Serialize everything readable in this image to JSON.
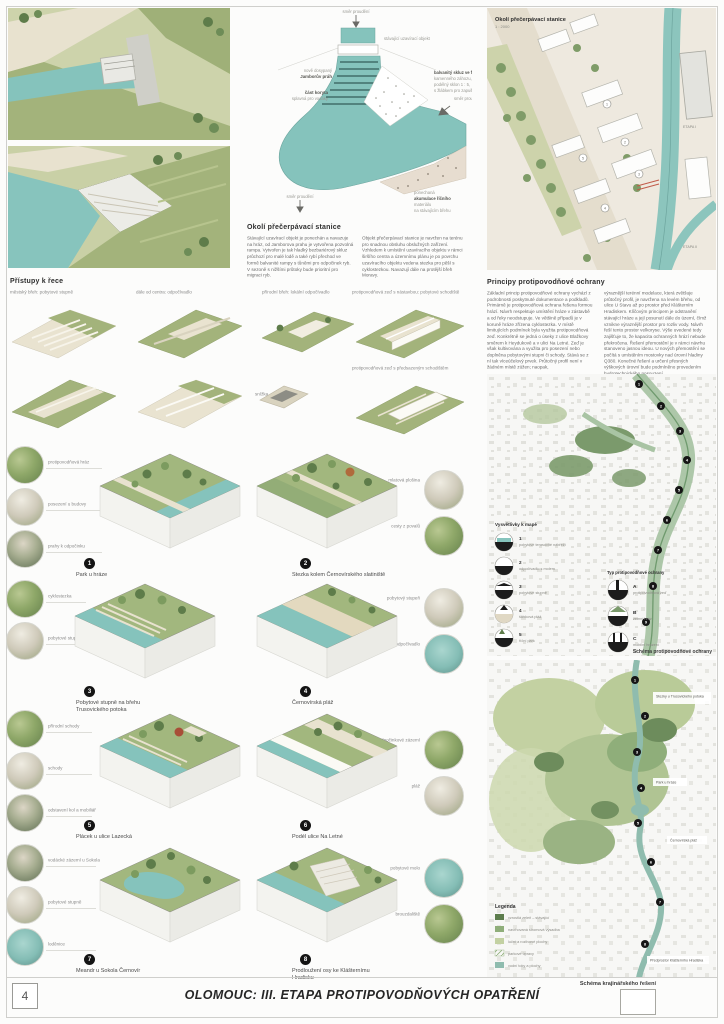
{
  "page": {
    "number": "4",
    "footer_title": "OLOMOUC: III. ETAPA PROTIPOVODŇOVÝCH OPATŘENÍ"
  },
  "weir_plan": {
    "flow_label": "směr proudění",
    "gate_label": "stávající uzavírací objekt",
    "prah_label_1": "nově dosypaný",
    "prah_label_2": "Jamborův práh",
    "koryto_label_1": "část koryta",
    "koryto_label_2": "splavná pro vodáky",
    "skluz_lines": [
      "balvanitý skluz ve formě",
      "kamenného záhozu,",
      "podélný sklon 1 : 5,",
      "s žlábkem pro zapuštění lodí"
    ],
    "akumulace_lines": [
      "ponechaná",
      "akumulace říčního",
      "materiálu",
      "na stávajícím břehu"
    ]
  },
  "pump_station": {
    "heading": "Okolí přečerpávací stanice",
    "col1": "Stávající uzavírací objekt je ponechán a navazuje na hráz, od Jamborova prahu je vytvořena pozvolná rampa. Vytvořen je tak hladký bezbariérový skluz průchozí pro malé lodě a také rybí přechod ve formě balvanité rampy s tůněmi pro odpočinek ryb. V sezoně s nižšími průtoky bude prioritní pro migraci ryb.",
    "col2": "Objekt přečerpávací stanice je navržen na terénu pro snadnou obsluhu obslužných zařízení. Vzhledem k umístění uzavíracího objektu v rámci širšího centra a územnímu plánu je po povrchu uzavíracího objektu vedena stezka pro pěší s cyklostezkou. Navazují dále na protější břeh Moravy."
  },
  "site_map": {
    "title": "Okolí přečerpávací stanice",
    "scale": "1 : 2000",
    "stage1": "ETAPA I",
    "stage2": "ETAPA II"
  },
  "access": {
    "heading": "Přístupy k řece",
    "variant1": "městský břeh: pobytové stupně",
    "variant2": "dále od centra: odpočívadlo",
    "variant3": "přírodní břeh: lokální odpočívadlo",
    "variant4": "protipovodňová zeď s nástavbou: pobytové schodiště",
    "note1": "snížka",
    "note2": "protipovodňová zeď s předsazeným schodištěm"
  },
  "principles": {
    "heading": "Principy protipovodňové ochrany",
    "col1": "Základní princip protipovodňové ochrany vychází z podrobnosti poskytnuté dokumentace a podkladů. Primárně je protipovodňová ochrana řešena formou hrází. Návrh respektuje umístění hráze v zástavbě a od řeky neodstupuje. Ve většině případů je v koruně hráze zřízena cyklostezka. V místě limitujících podmínek byla využita protipovodňová zeď. Konkrétně se jedná o úseky z ulice Blažkovy směrem k Heydukově a v ulici Na Letné. Zeď je však kultivována a využita pro posezení nebo doplněna pobytovými stupni či schody. Stává se z ní tak víceúčelový prvek. Průtočný profil není v žádném místě zúžen; naopak,",
    "col2": "výraznější terénní modelace, která zvětšuje průtočný profil, je navržena na levém břehu, od ulice U Stavu až po prostor před Klášterním Hradiskem. Klíčovým principem je odstranění stávající hráze a její posunutí dále do území, čímž vznikne výraznější prostor pro rozliv vody. Návrh řeší tento prostor velkoryse. Výše uvedené tedy zajišťuje to, že kapacita ochranných hrází nebude překročena. Řešení přemostění je v rámci návrhu stanoveno jasnou ideou. U nových přemostění se počítá s umístěním mostovky nad úrovní hladiny Q380. Konečné řešení a určení přesných výškových úrovní bude podmíněno provedením hydrotechnického posouzení."
  },
  "flood_map": {
    "legend_title": "Vysvětlivky k mapě",
    "items": [
      {
        "num": "1",
        "label": "pobytové terasovité nábřeží"
      },
      {
        "num": "2",
        "label": "odpočívadlo s molem"
      },
      {
        "num": "3",
        "label": "pobytové stupně"
      },
      {
        "num": "4",
        "label": "štěrková pláž"
      },
      {
        "num": "5",
        "label": "říční park"
      }
    ],
    "types_title": "Typ protipovodňové ochrany",
    "types": [
      {
        "letter": "A",
        "label": "protipovodňová zeď"
      },
      {
        "letter": "B",
        "label": "zemní hráz"
      },
      {
        "letter": "C",
        "label": "mobilní hrazení"
      }
    ],
    "caption": "Schéma protipovodňové ochrany",
    "points": [
      "1",
      "2",
      "3",
      "4",
      "5",
      "6",
      "7",
      "8",
      "9"
    ]
  },
  "landscape_map": {
    "caption": "Schéma krajinářského řešení",
    "legend_title": "Legenda",
    "legend": [
      {
        "label": "vzrostlá zeleň – stávající"
      },
      {
        "label": "navrhovaná stromová výsadba"
      },
      {
        "label": "luční a rozlivové plochy"
      },
      {
        "label": "parkové úpravy"
      },
      {
        "label": "vodní toky a plochy"
      }
    ],
    "labels": [
      "Stezky u Trusovického potoka",
      "Park u hráze",
      "Černovírská pláž",
      "Předprostor Klášterního Hradiska"
    ],
    "points": [
      "1",
      "2",
      "3",
      "4",
      "5",
      "6",
      "7",
      "8"
    ]
  },
  "blocks": [
    {
      "num": "1",
      "caption": "Park u hráze"
    },
    {
      "num": "2",
      "caption": "Stezka kolem Černovírského slatiniště"
    },
    {
      "num": "3",
      "caption": "Pobytové stupně na břehu Trusovického potoka"
    },
    {
      "num": "4",
      "caption": "Černovírská pláž"
    },
    {
      "num": "5",
      "caption": "Plácek u ulice Lazecká"
    },
    {
      "num": "6",
      "caption": "Podél ulice Na Letné"
    },
    {
      "num": "7",
      "caption": "Meandr u Sokola Černovír"
    },
    {
      "num": "8",
      "caption": "Prodloužení osy ke Klášternímu Hradisku"
    }
  ],
  "details": {
    "l1a": "protipovodňová hráz",
    "l1b": "posezení u budovy",
    "l1c": "prahy k odpočinku",
    "r1a": "mlatová plošina",
    "r1b": "cesty z povalů",
    "l2a": "cyklostezka",
    "l2b": "pobytové stupně",
    "r2a": "pobytový stupeň",
    "r2b": "dřevěné odpočívadlo",
    "l3a": "přírodní schody",
    "l3b": "schody",
    "l3c": "odstavení kol a mobiliář",
    "r3a": "odpočinkové zázemí",
    "r3b": "pláž",
    "l4a": "vodácké zázemí u Sokola",
    "l4b": "pobytové stupně",
    "l4c": "loděnice",
    "r4a": "pobytové molo",
    "r4b": "brouzdaliště"
  },
  "colors": {
    "water": "#85c3bc",
    "field": "#a3b37b",
    "tree": "#5e7c4a",
    "accent_dark": "#141414"
  }
}
